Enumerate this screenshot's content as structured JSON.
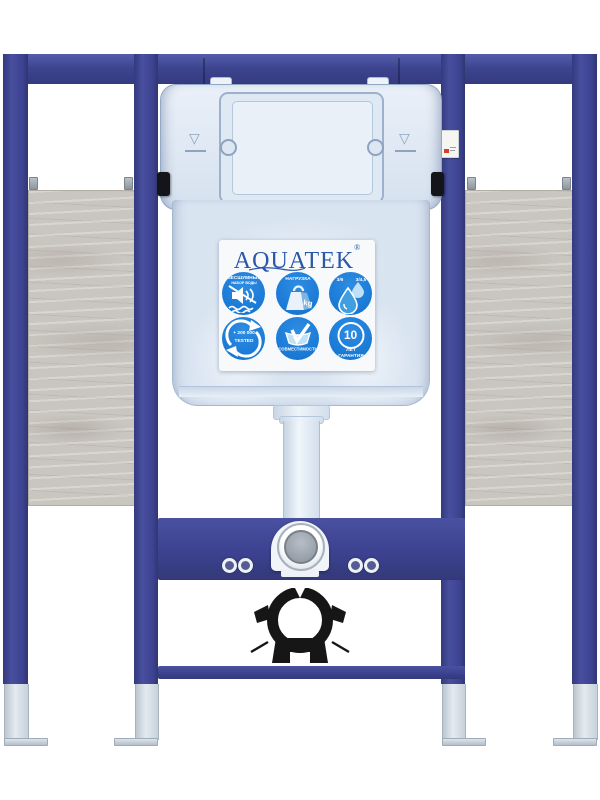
{
  "product": {
    "description": "AQUATEK concealed wall-hung toilet installation frame with white cistern, blue steel frame, plywood side panels, flush pipe, chrome valve and black pipe clamp"
  },
  "brand": {
    "name": "AQUATEK",
    "mark": "®"
  },
  "tank": {
    "level_mark": "▽"
  },
  "badges": {
    "silent": {
      "title": "БЕСШУМНЫЙ",
      "subtitle": "НАБОР ВОДЫ"
    },
    "load": {
      "title": "НАГРУЗКА",
      "unit": "kg"
    },
    "flush": {
      "mode_full": "3/6",
      "mode_eco": "3/4,5"
    },
    "tested": {
      "count": "+ 200 000",
      "label": "TESTED"
    },
    "compatibility": {
      "title": "СОВМЕСТИМОСТЬ"
    },
    "warranty": {
      "years": "10",
      "line1": "ЛЕТ",
      "line2": "ГАРАНТИЯ"
    }
  },
  "colors": {
    "frame_blue": "#3e4590",
    "badge_blue": "#1a7dd8",
    "logo_blue": "#2a57a8",
    "wood_grey": "#c9c6c0",
    "steel_grey": "#ccd5de",
    "clamp_black": "#161616",
    "tank_white": "#dce6f2"
  }
}
